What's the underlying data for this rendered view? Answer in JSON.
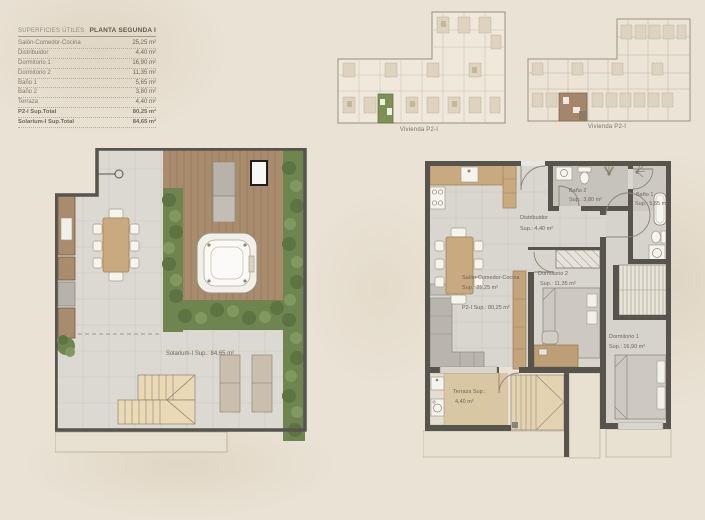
{
  "sheet": {
    "table": {
      "title_left": "SUPERFICIES ÚTILES",
      "title_right": "PLANTA SEGUNDA I",
      "rows": [
        {
          "label": "Salón-Comedor-Cocina",
          "value": "25,25 m²"
        },
        {
          "label": "Distribuidor",
          "value": "4,40 m²"
        },
        {
          "label": "Dormitorio 1",
          "value": "16,90 m²"
        },
        {
          "label": "Dormitorio 2",
          "value": "11,35 m²"
        },
        {
          "label": "Baño 1",
          "value": "5,65 m²"
        },
        {
          "label": "Baño 2",
          "value": "3,80 m²"
        },
        {
          "label": "Terraza",
          "value": "4,40 m²"
        },
        {
          "label": "P2-I Sup.Total",
          "value": "80,25 m²"
        },
        {
          "label": "Solarium-I Sup.Total",
          "value": "84,65 m²"
        }
      ]
    },
    "key_plans": [
      {
        "caption": "Vivienda P2-I"
      },
      {
        "caption": "Vivienda P2-I"
      }
    ],
    "solarium_plan": {
      "area_label": "Solarium-I Sup.: 84,65 m²"
    },
    "apartment_plan": {
      "salon": {
        "name": "Salón-Comedor-Cocina",
        "sup": "Sup.: 25,25 m²",
        "total": "P2-I Sup.: 80,25 m²"
      },
      "distribuidor": {
        "name": "Distribuidor",
        "sup": "Sup.: 4,40 m²"
      },
      "bano2": {
        "name": "Baño 2",
        "sup": "Sup.: 3,80 m²"
      },
      "bano1": {
        "name": "Baño 1",
        "sup": "Sup.: 5,65 m²"
      },
      "dorm2": {
        "name": "Dormitorio 2",
        "sup": "Sup.: 11,35 m²"
      },
      "dorm1": {
        "name": "Dormitorio 1",
        "sup": "Sup.: 16,90 m²"
      },
      "terraza": {
        "name": "Terraza Sup.:",
        "sup": "4,40 m²"
      }
    },
    "colors": {
      "background": "#eae2d5",
      "wall": "#57544e",
      "tile_floor": "#dcd9d2",
      "deck_wood": "#a98b6d",
      "hedge_green": "#6f8550",
      "furniture_wood": "#c9a97f",
      "highlight_green": "#7f9055",
      "highlight_brown": "#a5866a"
    }
  }
}
